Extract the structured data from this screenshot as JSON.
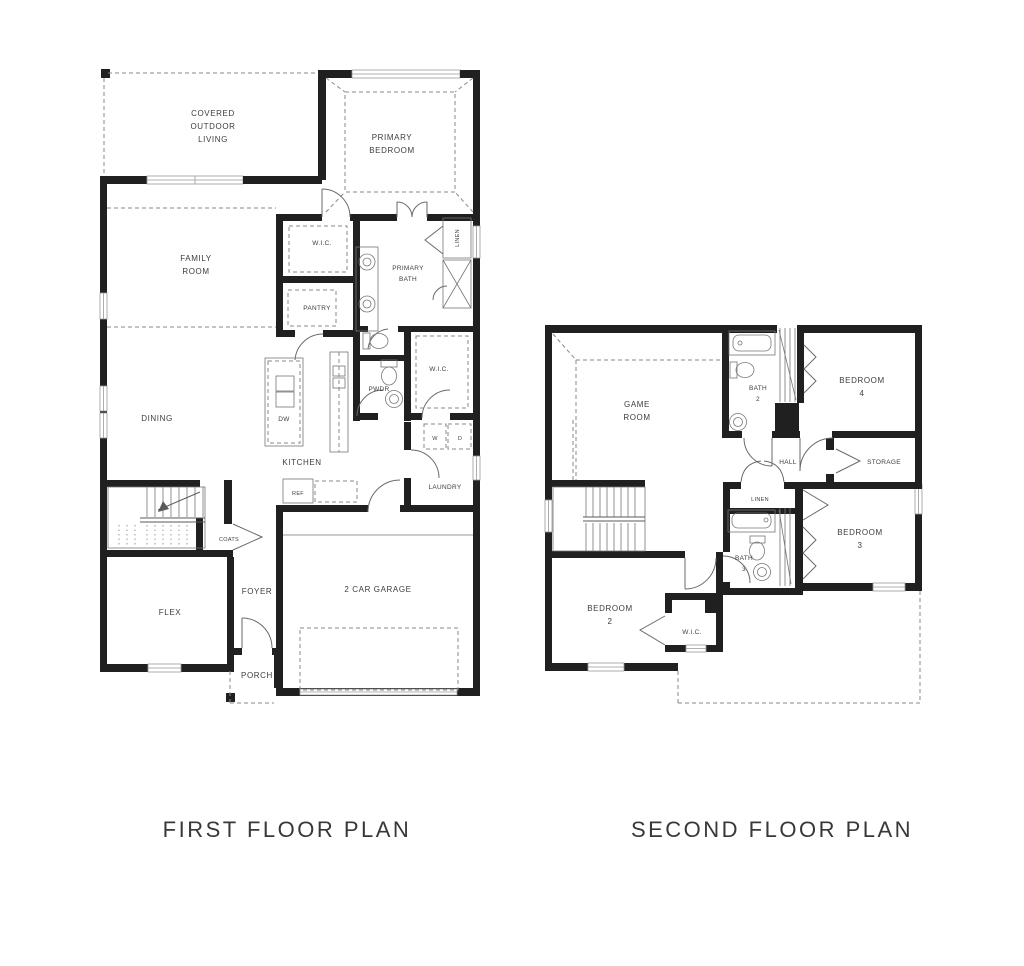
{
  "palette": {
    "ink": "#202020",
    "thin_line": "#5a5a5a",
    "dash_line": "#8a8a8a",
    "background": "#ffffff"
  },
  "first_floor": {
    "title": "FIRST FLOOR PLAN",
    "labels": {
      "covered_outdoor_living": [
        "COVERED",
        "OUTDOOR",
        "LIVING"
      ],
      "primary_bedroom": [
        "PRIMARY",
        "BEDROOM"
      ],
      "family_room": [
        "FAMILY",
        "ROOM"
      ],
      "wic_primary": "W.I.C.",
      "primary_bath": [
        "PRIMARY",
        "BATH"
      ],
      "linen": "LINEN",
      "pantry": "PANTRY",
      "dining": "DINING",
      "pwdr": "PWDR",
      "wic_hall": "W.I.C.",
      "kitchen": "KITCHEN",
      "dw": "DW",
      "ref": "REF",
      "washer": "W",
      "dryer": "D",
      "laundry": "LAUNDRY",
      "coats": "COATS",
      "foyer": "FOYER",
      "flex": "FLEX",
      "garage": "2 CAR GARAGE",
      "porch": "PORCH"
    }
  },
  "second_floor": {
    "title": "SECOND FLOOR PLAN",
    "labels": {
      "game_room": [
        "GAME",
        "ROOM"
      ],
      "bath2": [
        "BATH",
        "2"
      ],
      "bedroom4": [
        "BEDROOM",
        "4"
      ],
      "hall": "HALL",
      "storage": "STORAGE",
      "linen": "LINEN",
      "bath3": [
        "BATH",
        "3"
      ],
      "bedroom3": [
        "BEDROOM",
        "3"
      ],
      "bedroom2": [
        "BEDROOM",
        "2"
      ],
      "wic": "W.I.C."
    }
  }
}
